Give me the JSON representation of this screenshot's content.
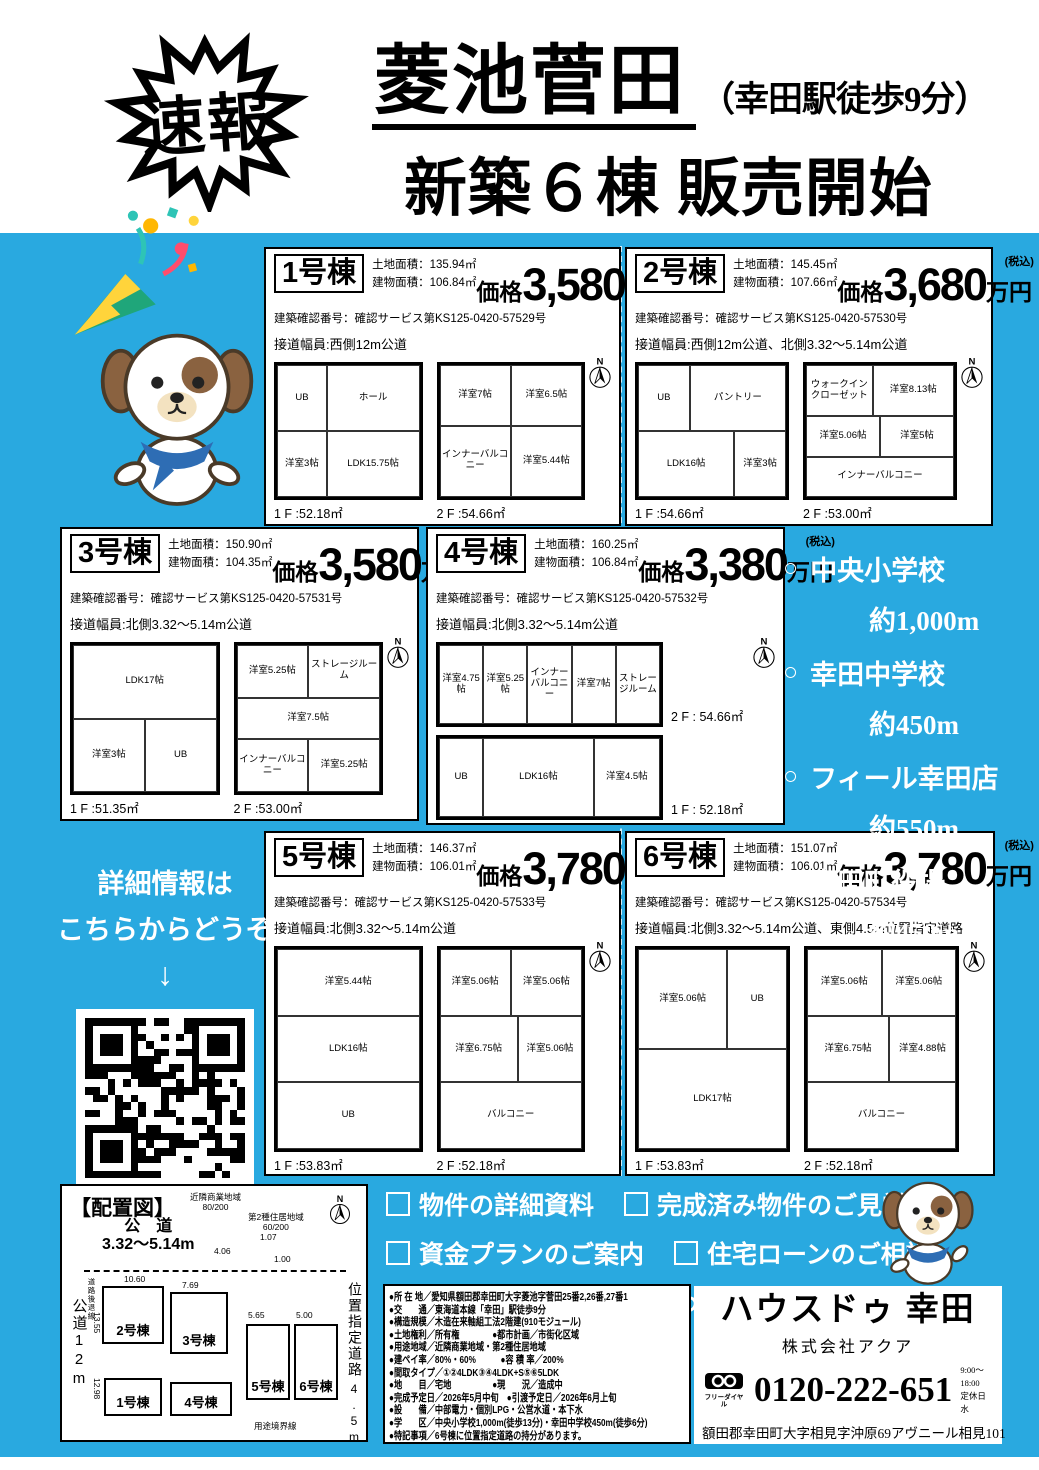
{
  "colors": {
    "blue": "#29a9e0",
    "scarf": "#2e6db4",
    "dog-brown": "#8a6240",
    "dog-tan": "#f3e2c0"
  },
  "header": {
    "burst": "速報",
    "title": "菱池菅田",
    "title_note": "（幸田駅徒歩9分）",
    "subtitle": "新築６棟 販売開始"
  },
  "labels": {
    "land": "土地面積：",
    "building": "建物面積：",
    "price": "価格",
    "unit": "万円",
    "tax": "(税込)",
    "north": "N"
  },
  "buildings": [
    {
      "name": "1号棟",
      "land_area": "135.94㎡",
      "building_area": "106.84㎡",
      "price": "3,580",
      "confirmation": "建築確認番号：確認サービス第KS125-0420-57529号",
      "road": "接道幅員:西側12m公道",
      "floor1": {
        "label": "1 F :52.18㎡",
        "rooms": [
          "UB",
          "ホール",
          "洋室3帖",
          "LDK15.75帖"
        ]
      },
      "floor2": {
        "label": "2 F :54.66㎡",
        "rooms": [
          "洋室7帖",
          "洋室6.5帖",
          "インナーバルコニー",
          "洋室5.44帖"
        ]
      }
    },
    {
      "name": "2号棟",
      "land_area": "145.45㎡",
      "building_area": "107.66㎡",
      "price": "3,680",
      "confirmation": "建築確認番号：確認サービス第KS125-0420-57530号",
      "road": "接道幅員:西側12m公道、北側3.32～5.14m公道",
      "floor1": {
        "label": "1 F :54.66㎡",
        "rooms": [
          "UB",
          "パントリー",
          "LDK16帖",
          "洋室3帖"
        ]
      },
      "floor2": {
        "label": "2 F :53.00㎡",
        "rooms": [
          "ウォークインクローゼット",
          "洋室8.13帖",
          "洋室5.06帖",
          "洋室5帖",
          "インナーバルコニー"
        ]
      }
    },
    {
      "name": "3号棟",
      "land_area": "150.90㎡",
      "building_area": "104.35㎡",
      "price": "3,580",
      "confirmation": "建築確認番号：確認サービス第KS125-0420-57531号",
      "road": "接道幅員:北側3.32～5.14m公道",
      "floor1": {
        "label": "1 F :51.35㎡",
        "rooms": [
          "LDK17帖",
          "洋室3帖",
          "UB"
        ]
      },
      "floor2": {
        "label": "2 F :53.00㎡",
        "rooms": [
          "洋室5.25帖",
          "ストレージルーム",
          "洋室7.5帖",
          "インナーバルコニー",
          "洋室5.25帖"
        ]
      }
    },
    {
      "name": "4号棟",
      "land_area": "160.25㎡",
      "building_area": "106.84㎡",
      "price": "3,380",
      "confirmation": "建築確認番号：確認サービス第KS125-0420-57532号",
      "road": "接道幅員:北側3.32～5.14m公道",
      "floor1": {
        "label": "1 F : 52.18㎡",
        "rooms": [
          "UB",
          "LDK16帖",
          "洋室4.5帖"
        ]
      },
      "floor2": {
        "label": "2 F : 54.66㎡",
        "rooms": [
          "洋室4.75帖",
          "洋室5.25帖",
          "インナーバルコニー",
          "洋室7帖",
          "ストレージルーム"
        ]
      }
    },
    {
      "name": "5号棟",
      "land_area": "146.37㎡",
      "building_area": "106.01㎡",
      "price": "3,780",
      "confirmation": "建築確認番号：確認サービス第KS125-0420-57533号",
      "road": "接道幅員:北側3.32～5.14m公道",
      "floor1": {
        "label": "1 F :53.83㎡",
        "rooms": [
          "洋室5.44帖",
          "LDK16帖",
          "UB"
        ]
      },
      "floor2": {
        "label": "2 F :52.18㎡",
        "rooms": [
          "洋室5.06帖",
          "洋室5.06帖",
          "洋室6.75帖",
          "洋室5.06帖",
          "バルコニー"
        ]
      }
    },
    {
      "name": "6号棟",
      "land_area": "151.07㎡",
      "building_area": "106.01㎡",
      "price": "3,780",
      "confirmation": "建築確認番号：確認サービス第KS125-0420-57534号",
      "road": "接道幅員:北側3.32～5.14m公道、東側4.5m位置指定道路",
      "floor1": {
        "label": "1 F :53.83㎡",
        "rooms": [
          "洋室5.06帖",
          "UB",
          "LDK17帖"
        ]
      },
      "floor2": {
        "label": "2 F :52.18㎡",
        "rooms": [
          "洋室5.06帖",
          "洋室5.06帖",
          "洋室6.75帖",
          "洋室4.88帖",
          "バルコニー"
        ]
      }
    }
  ],
  "facilities": {
    "bullet": "○",
    "items": [
      {
        "name": "中央小学校",
        "distance": "約1,000m"
      },
      {
        "name": "幸田中学校",
        "distance": "約450m"
      },
      {
        "name": "フィール幸田店",
        "distance": "約550m"
      },
      {
        "name": "幸田町役場",
        "distance": "約450m"
      }
    ]
  },
  "qr_section": {
    "line1": "詳細情報は",
    "line2": "こちらからどうぞ",
    "arrow": "↓"
  },
  "site_plan": {
    "title": "【配置図】",
    "zoning1_name": "近隣商業地域",
    "zoning1_ratio": "80/200",
    "zoning2_name": "第2種住居地域",
    "zoning2_ratio": "60/200",
    "road_top_name": "公　道",
    "road_top_width": "3.32～5.14m",
    "road_left": "公道12m",
    "road_right_name": "位置指定道路",
    "road_right_width": "4.5m",
    "setback": "道路後退線",
    "boundary": "用途境界線",
    "lots": [
      "1号棟",
      "2号棟",
      "3号棟",
      "4号棟",
      "5号棟",
      "6号棟"
    ],
    "dims": {
      "d1": "10.60",
      "d2": "7.69",
      "d3": "5.65",
      "d4": "5.00",
      "d5": "13.55",
      "d6": "12.98",
      "d7": "4.06",
      "d8": "1.07",
      "d9": "1.00"
    }
  },
  "cta": {
    "items": [
      "物件の詳細資料",
      "完成済み物件のご見学",
      "資金プランのご案内",
      "住宅ローンのご相談"
    ],
    "message": "まずはお気軽にお問い合わせくださいませ。"
  },
  "details": {
    "rows": [
      "●所 在 地／愛知県額田郡幸田町大字菱池字菅田25番2,26番,27番1",
      "●交　　通／東海道本線「幸田」駅徒歩9分",
      "●構造規模／木造在来軸組工法2階建(910モジュール)",
      "●土地権利／所有権　　　　●都市計画／市街化区域",
      "●用途地域／近隣商業地域・第2種住居地域",
      "●建ペイ率／80%・60%　　　●容 積 率／200%",
      "●間取タイプ／①②4LDK③④4LDK+S⑤⑥5LDK",
      "●地　　目／宅地　　　　　●現　　況／造成中",
      "●完成予定日／2026年5月中旬　●引渡予定日／2026年6月上旬",
      "●設　　備／中部電力・個別LPG・公営水道・本下水",
      "●学　　区／中央小学校1,000m(徒歩13分)・幸田中学校450m(徒歩6分)",
      "●特記事項／6号棟に位置指定道路の持分があります。"
    ]
  },
  "company": {
    "name": "ハウスドゥ 幸田",
    "corp": "株式会社アクア",
    "freedial": "フリーダイヤル",
    "phone": "0120-222-651",
    "hours": "9:00～18:00",
    "closed": "定休日 水",
    "address": "額田郡幸田町大字相見字沖原69アヴニール相見101"
  }
}
